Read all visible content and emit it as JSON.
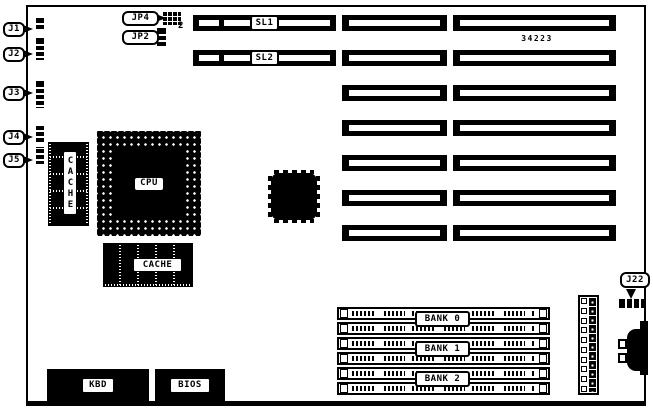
{
  "board": {
    "colors": {
      "ink": "#000000",
      "paper": "#ffffff"
    },
    "part_number": "34223",
    "left_connectors": [
      {
        "label": "J1"
      },
      {
        "label": "J2"
      },
      {
        "label": "J3"
      },
      {
        "label": "J4"
      },
      {
        "label": "J5"
      }
    ],
    "jumpers": {
      "jp4": {
        "label": "JP4",
        "pin_number": "2"
      },
      "jp2": {
        "label": "JP2"
      }
    },
    "slots": {
      "sl1_label": "SL1",
      "sl2_label": "SL2"
    },
    "cpu": {
      "label": "CPU"
    },
    "cache": {
      "vertical_label": "CACHE",
      "horizontal_label": "CACHE"
    },
    "memory": {
      "banks": [
        {
          "label": "BANK 0"
        },
        {
          "label": "BANK 1"
        },
        {
          "label": "BANK 2"
        }
      ]
    },
    "j22": {
      "label": "J22"
    },
    "kbd": {
      "label": "KBD"
    },
    "bios": {
      "label": "BIOS"
    }
  }
}
